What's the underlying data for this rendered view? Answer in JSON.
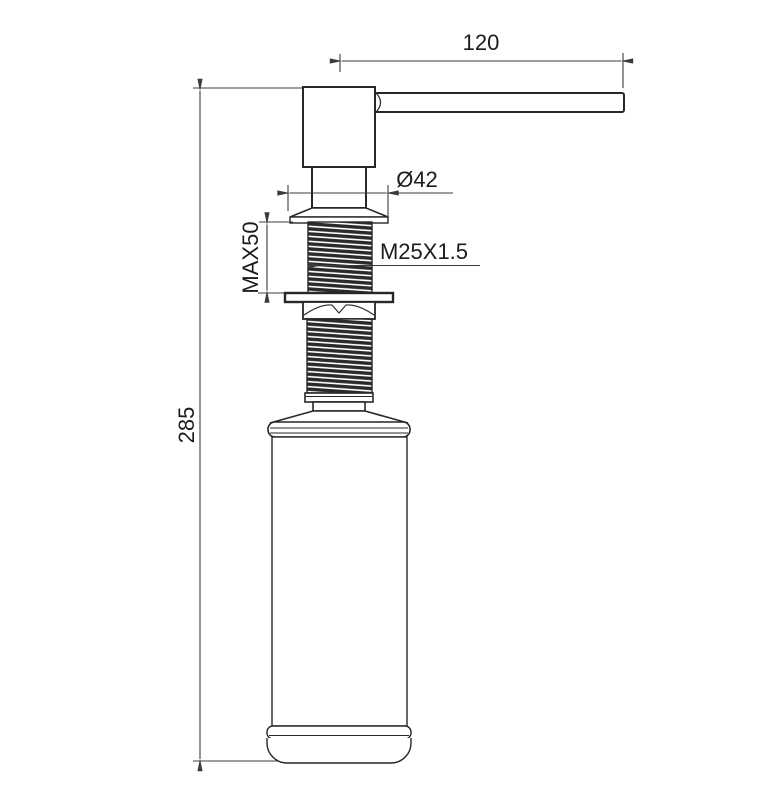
{
  "drawing": {
    "type": "technical-drawing",
    "subject": "kitchen soap dispenser side elevation",
    "background": "#ffffff",
    "line_color": "#272727",
    "dimension_color": "#3c3c3c",
    "text_color": "#1c1c1c",
    "dimensions": {
      "spout_length": "120",
      "flange_diameter": "Ø42",
      "max_deck_thickness": "MAX50",
      "thread_spec": "M25X1.5",
      "overall_height": "285"
    }
  }
}
